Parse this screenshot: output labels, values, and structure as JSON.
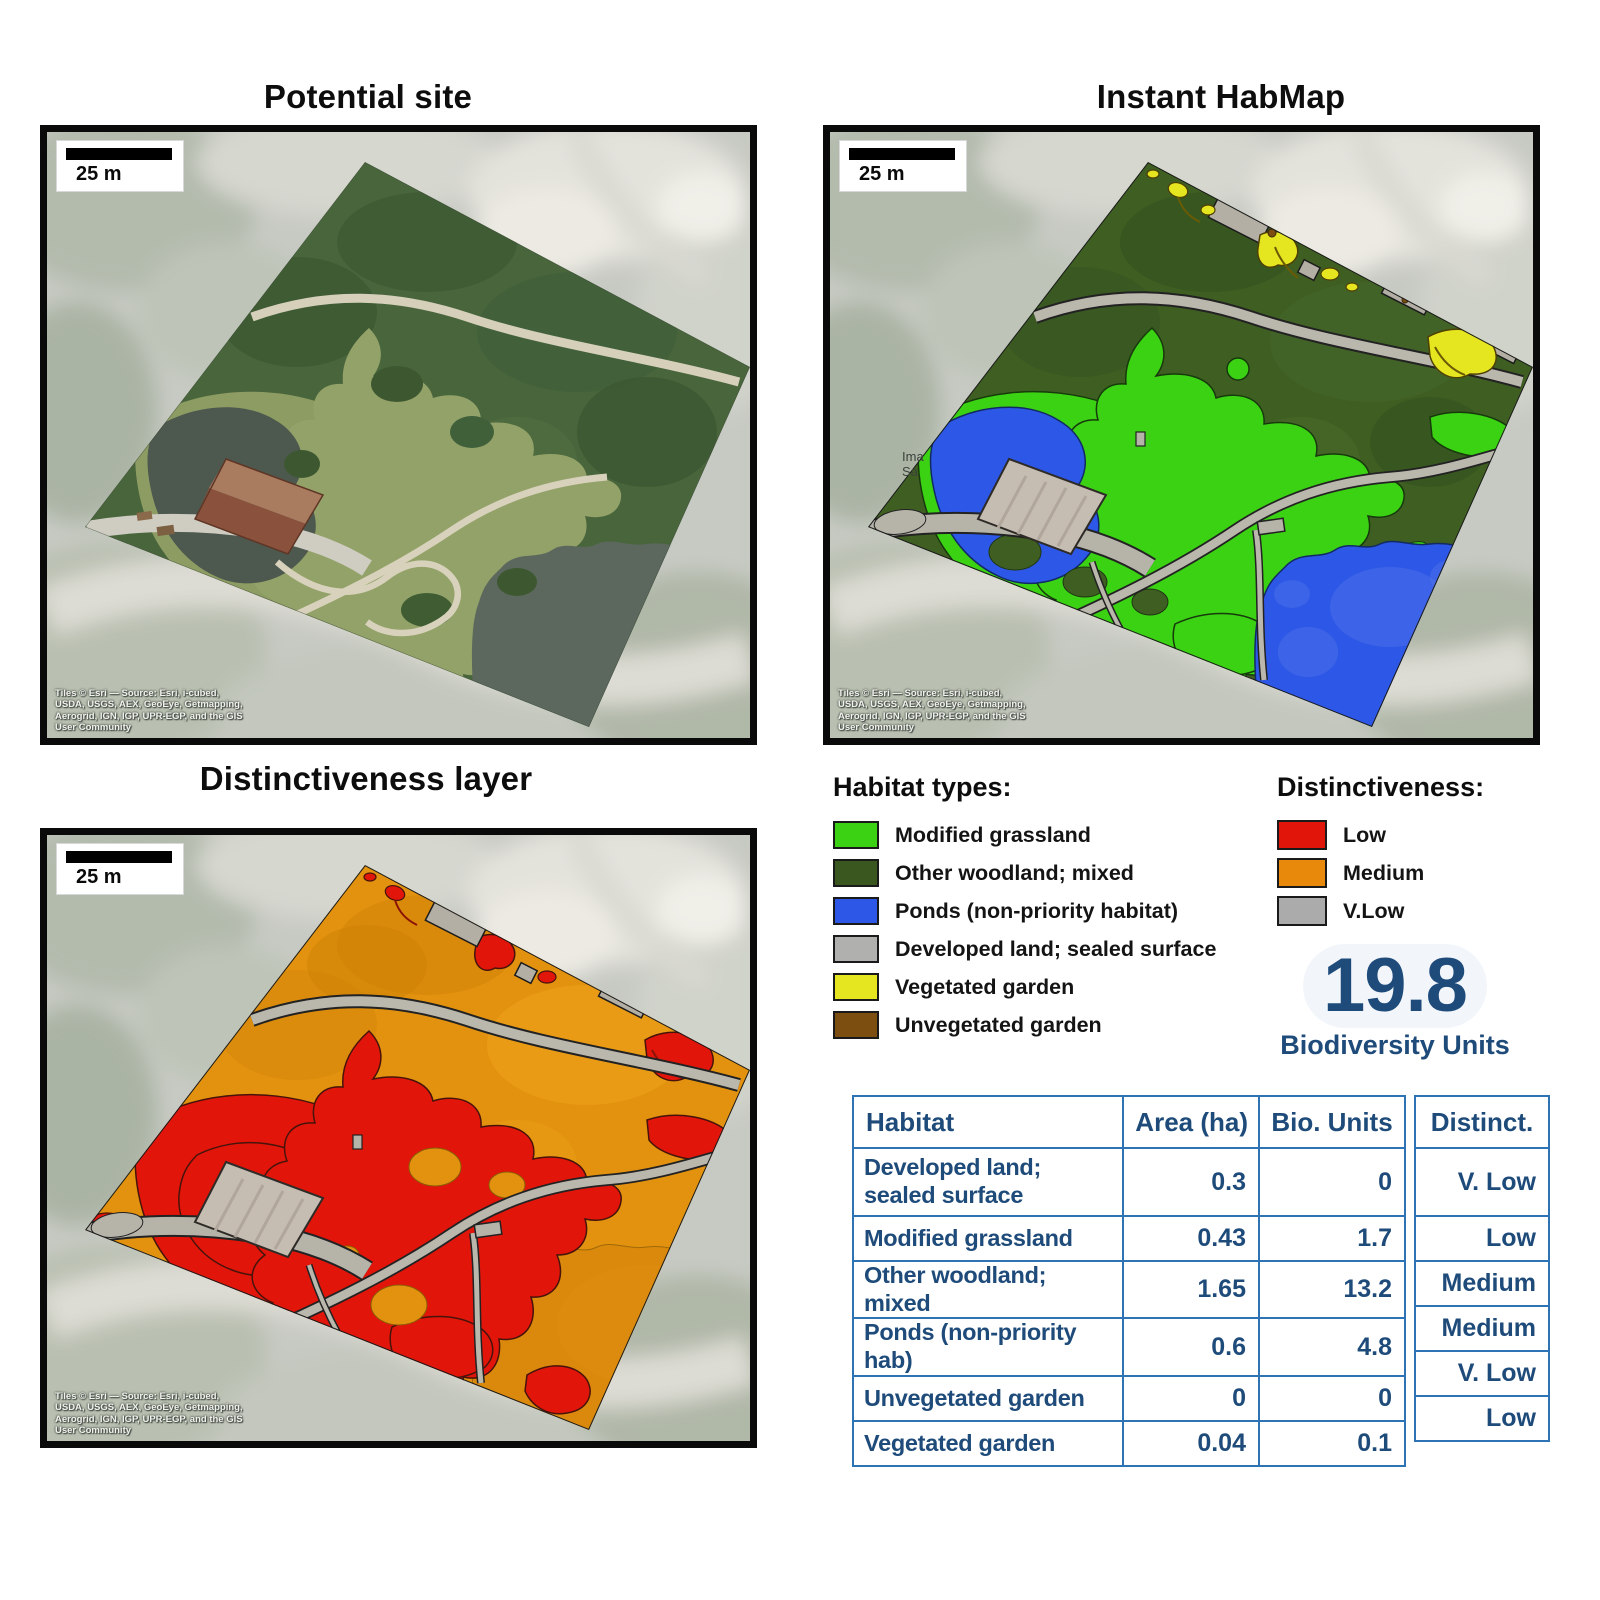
{
  "panels": {
    "potential_site": {
      "title": "Potential site",
      "scale_label": "25 m"
    },
    "instant_habmap": {
      "title": "Instant HabMap",
      "scale_label": "25 m",
      "partial_label": "Ima\nSa"
    },
    "distinctiveness": {
      "title": "Distinctiveness layer",
      "scale_label": "25 m"
    }
  },
  "attribution": {
    "text": "Tiles © Esri — Source: Esri, i-cubed,\nUSDA, USGS, AEX, GeoEye, Getmapping,\nAerogrid, IGN, IGP, UPR-EGP, and the GIS\nUser Community"
  },
  "legend_habitat": {
    "heading": "Habitat types:",
    "items": [
      {
        "label": "Modified grassland",
        "color": "#3bd214"
      },
      {
        "label": "Other woodland; mixed",
        "color": "#3a571f"
      },
      {
        "label": "Ponds (non-priority habitat)",
        "color": "#2d57e6"
      },
      {
        "label": "Developed land; sealed surface",
        "color": "#b0b0ae"
      },
      {
        "label": "Vegetated garden",
        "color": "#e5e61f"
      },
      {
        "label": "Unvegetated garden",
        "color": "#7c4f11"
      }
    ]
  },
  "legend_distinctiveness": {
    "heading": "Distinctiveness:",
    "items": [
      {
        "label": "Low",
        "color": "#e2150b"
      },
      {
        "label": "Medium",
        "color": "#e8890b"
      },
      {
        "label": "V.Low",
        "color": "#ababab"
      }
    ]
  },
  "score": {
    "value": "19.8",
    "label": "Biodiversity Units"
  },
  "table": {
    "headers": [
      "Habitat",
      "Area (ha)",
      "Bio. Units",
      "Distinct."
    ],
    "rows": [
      [
        "Developed land; sealed surface",
        "0.3",
        "0",
        "V. Low"
      ],
      [
        "Modified grassland",
        "0.43",
        "1.7",
        "Low"
      ],
      [
        "Other woodland; mixed",
        "1.65",
        "13.2",
        "Medium"
      ],
      [
        "Ponds (non-priority hab)",
        "0.6",
        "4.8",
        "Medium"
      ],
      [
        "Unvegetated garden",
        "0",
        "0",
        "V. Low"
      ],
      [
        "Vegetated garden",
        "0.04",
        "0.1",
        "Low"
      ]
    ]
  }
}
